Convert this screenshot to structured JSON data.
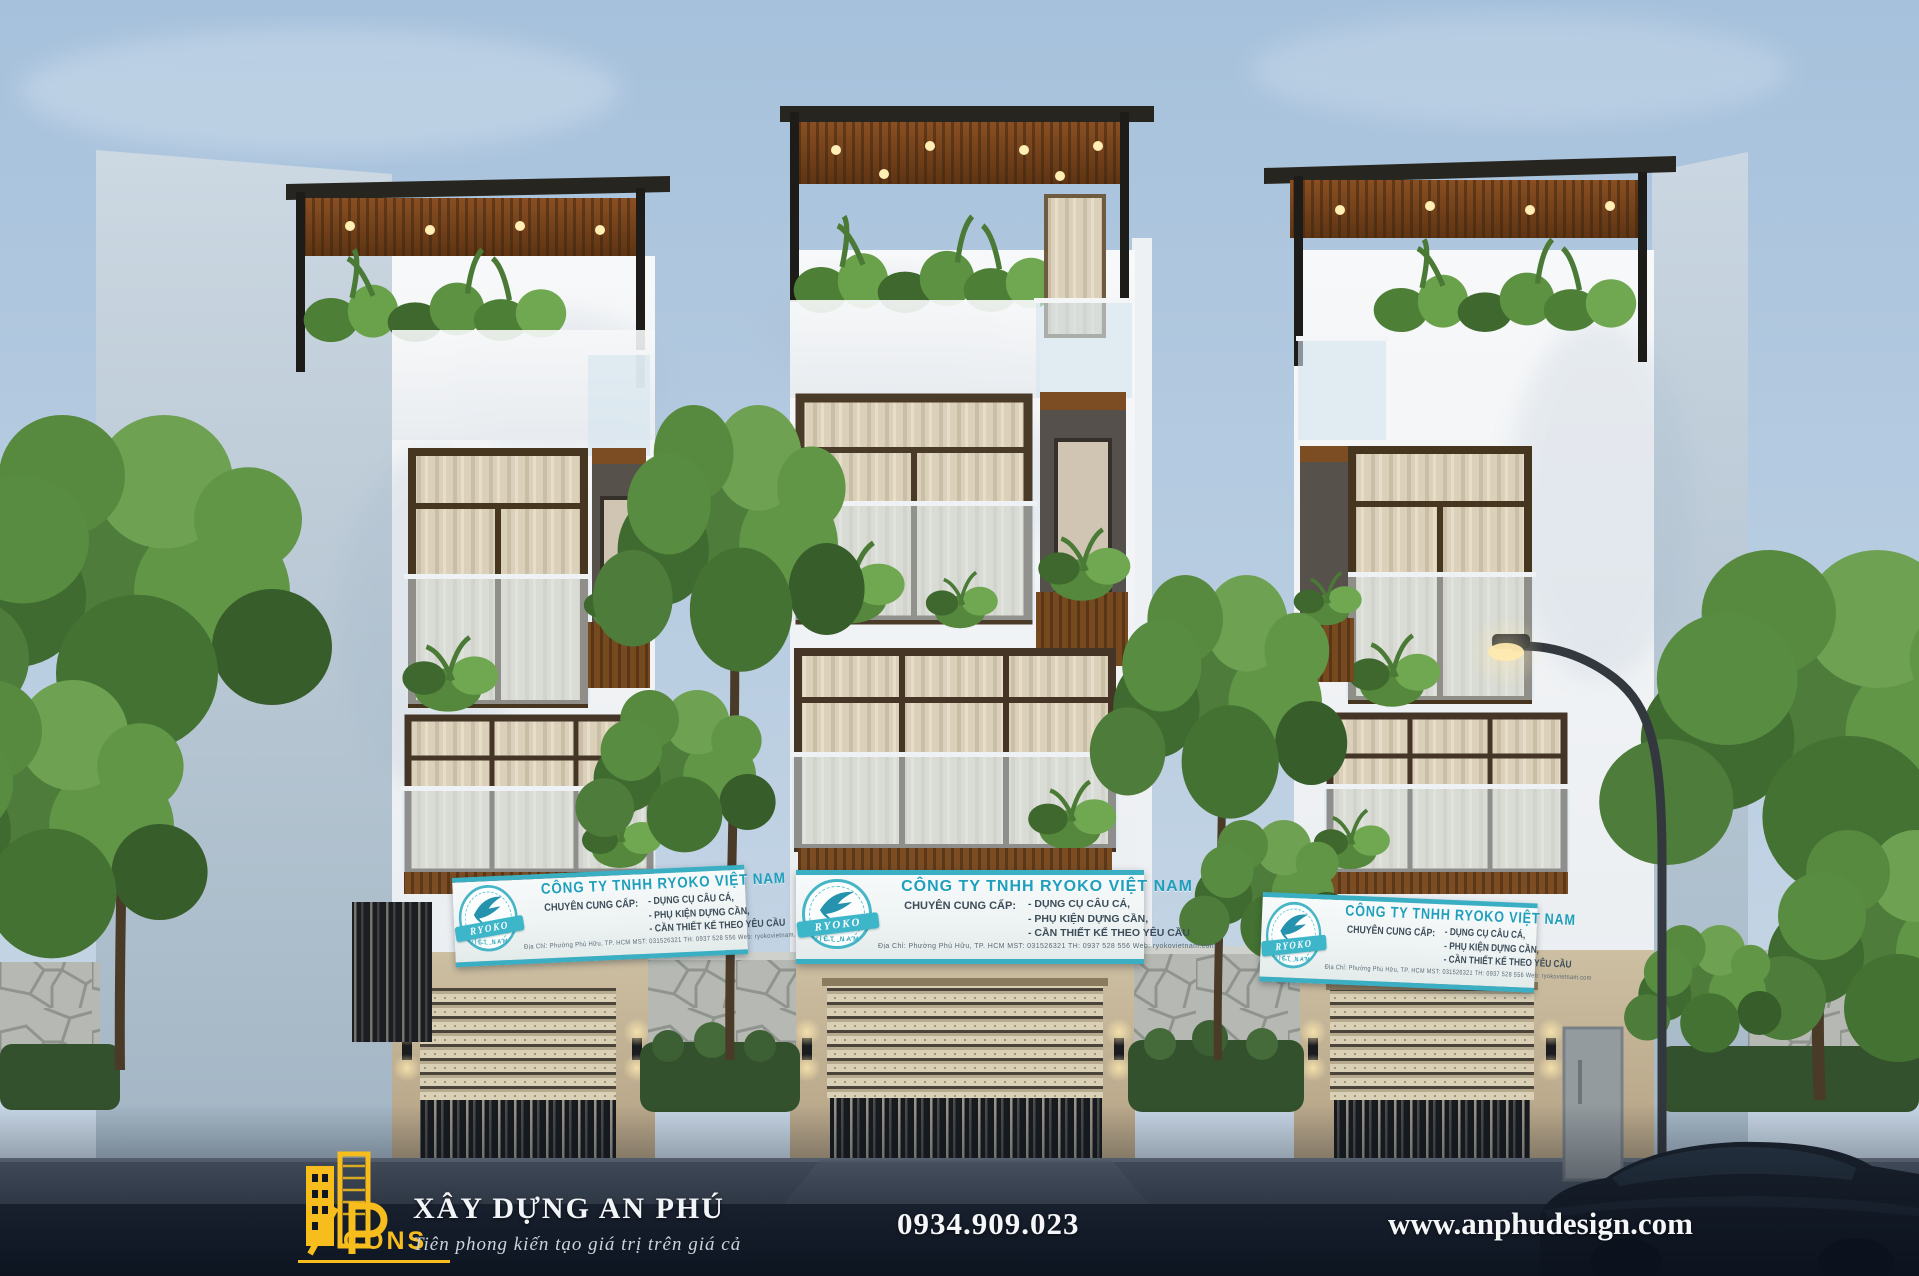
{
  "banner": {
    "accent_color": "#2fa8bd",
    "title": "CÔNG TY TNHH RYOKO VIỆT NAM",
    "supply_label": "CHUYÊN CUNG CẤP:",
    "items": [
      "- DỤNG CỤ CÂU CÁ,",
      "- PHỤ KIỆN DỰNG CẦN,",
      "- CẦN THIẾT KẾ THEO YÊU CẦU"
    ],
    "info_line": "Địa Chỉ: Phường Phú Hữu, TP. HCM        MST: 031526321        TH: 0937 528 556        Web: ryokovietnam.com",
    "logo": {
      "name": "RYOKO",
      "sub": "VIỆT NAM"
    }
  },
  "footer": {
    "logo_text": "CONS",
    "logo_color": "#f6bd1d",
    "company": "XÂY DỰNG AN PHÚ",
    "tagline": "Tiên phong kiến tạo giá trị trên giá cả",
    "phone": "0934.909.023",
    "website": "www.anphudesign.com"
  }
}
